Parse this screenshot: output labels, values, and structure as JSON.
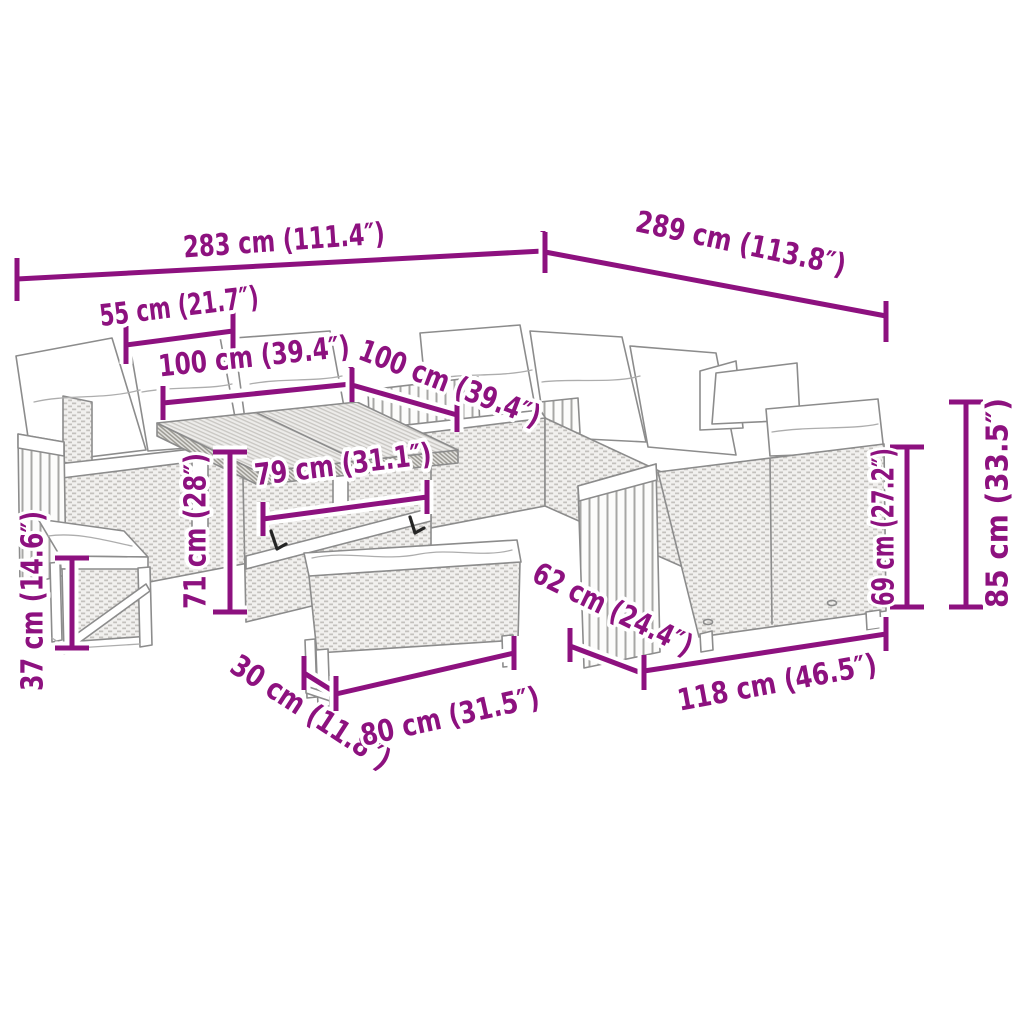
{
  "accent_color": "#8d117f",
  "diagram_type": "product-dimension-diagram",
  "product": "outdoor rattan lounge set with lift table, bench and stool",
  "units": [
    "cm",
    "inches"
  ],
  "dimensions": {
    "overall_width_left": {
      "cm": 283,
      "in": 111.4,
      "label": "283 cm (111.4″)"
    },
    "overall_width_right": {
      "cm": 289,
      "in": 113.8,
      "label": "289 cm (113.8″)"
    },
    "armrest_width": {
      "cm": 55,
      "in": 21.7,
      "label": "55 cm (21.7″)"
    },
    "left_seat_width": {
      "cm": 100,
      "in": 39.4,
      "label": "100  cm (39.4″)"
    },
    "back_seat_width": {
      "cm": 100,
      "in": 39.4,
      "label": "100 cm (39.4″)"
    },
    "table_width": {
      "cm": 79,
      "in": 31.1,
      "label": "79 cm (31.1″)"
    },
    "table_height": {
      "cm": 71,
      "in": 28,
      "label": "71 cm (28″)"
    },
    "stool_height": {
      "cm": 37,
      "in": 14.6,
      "label": "37 cm (14.6″)"
    },
    "bench_depth": {
      "cm": 30,
      "in": 11.8,
      "label": "30 cm (11.8″)"
    },
    "bench_width": {
      "cm": 80,
      "in": 31.5,
      "label": "80 cm (31.5″)"
    },
    "right_sofa_depth": {
      "cm": 62,
      "in": 24.4,
      "label": "62 cm (24.4″)"
    },
    "right_sofa_width": {
      "cm": 118,
      "in": 46.5,
      "label": "118 cm (46.5″)"
    },
    "backrest_height": {
      "cm": 69,
      "in": 27.2,
      "label": "69 cm (27.2″)"
    },
    "overall_height": {
      "cm": 85,
      "in": 33.5,
      "label": "85 cm (33.5″)"
    }
  }
}
